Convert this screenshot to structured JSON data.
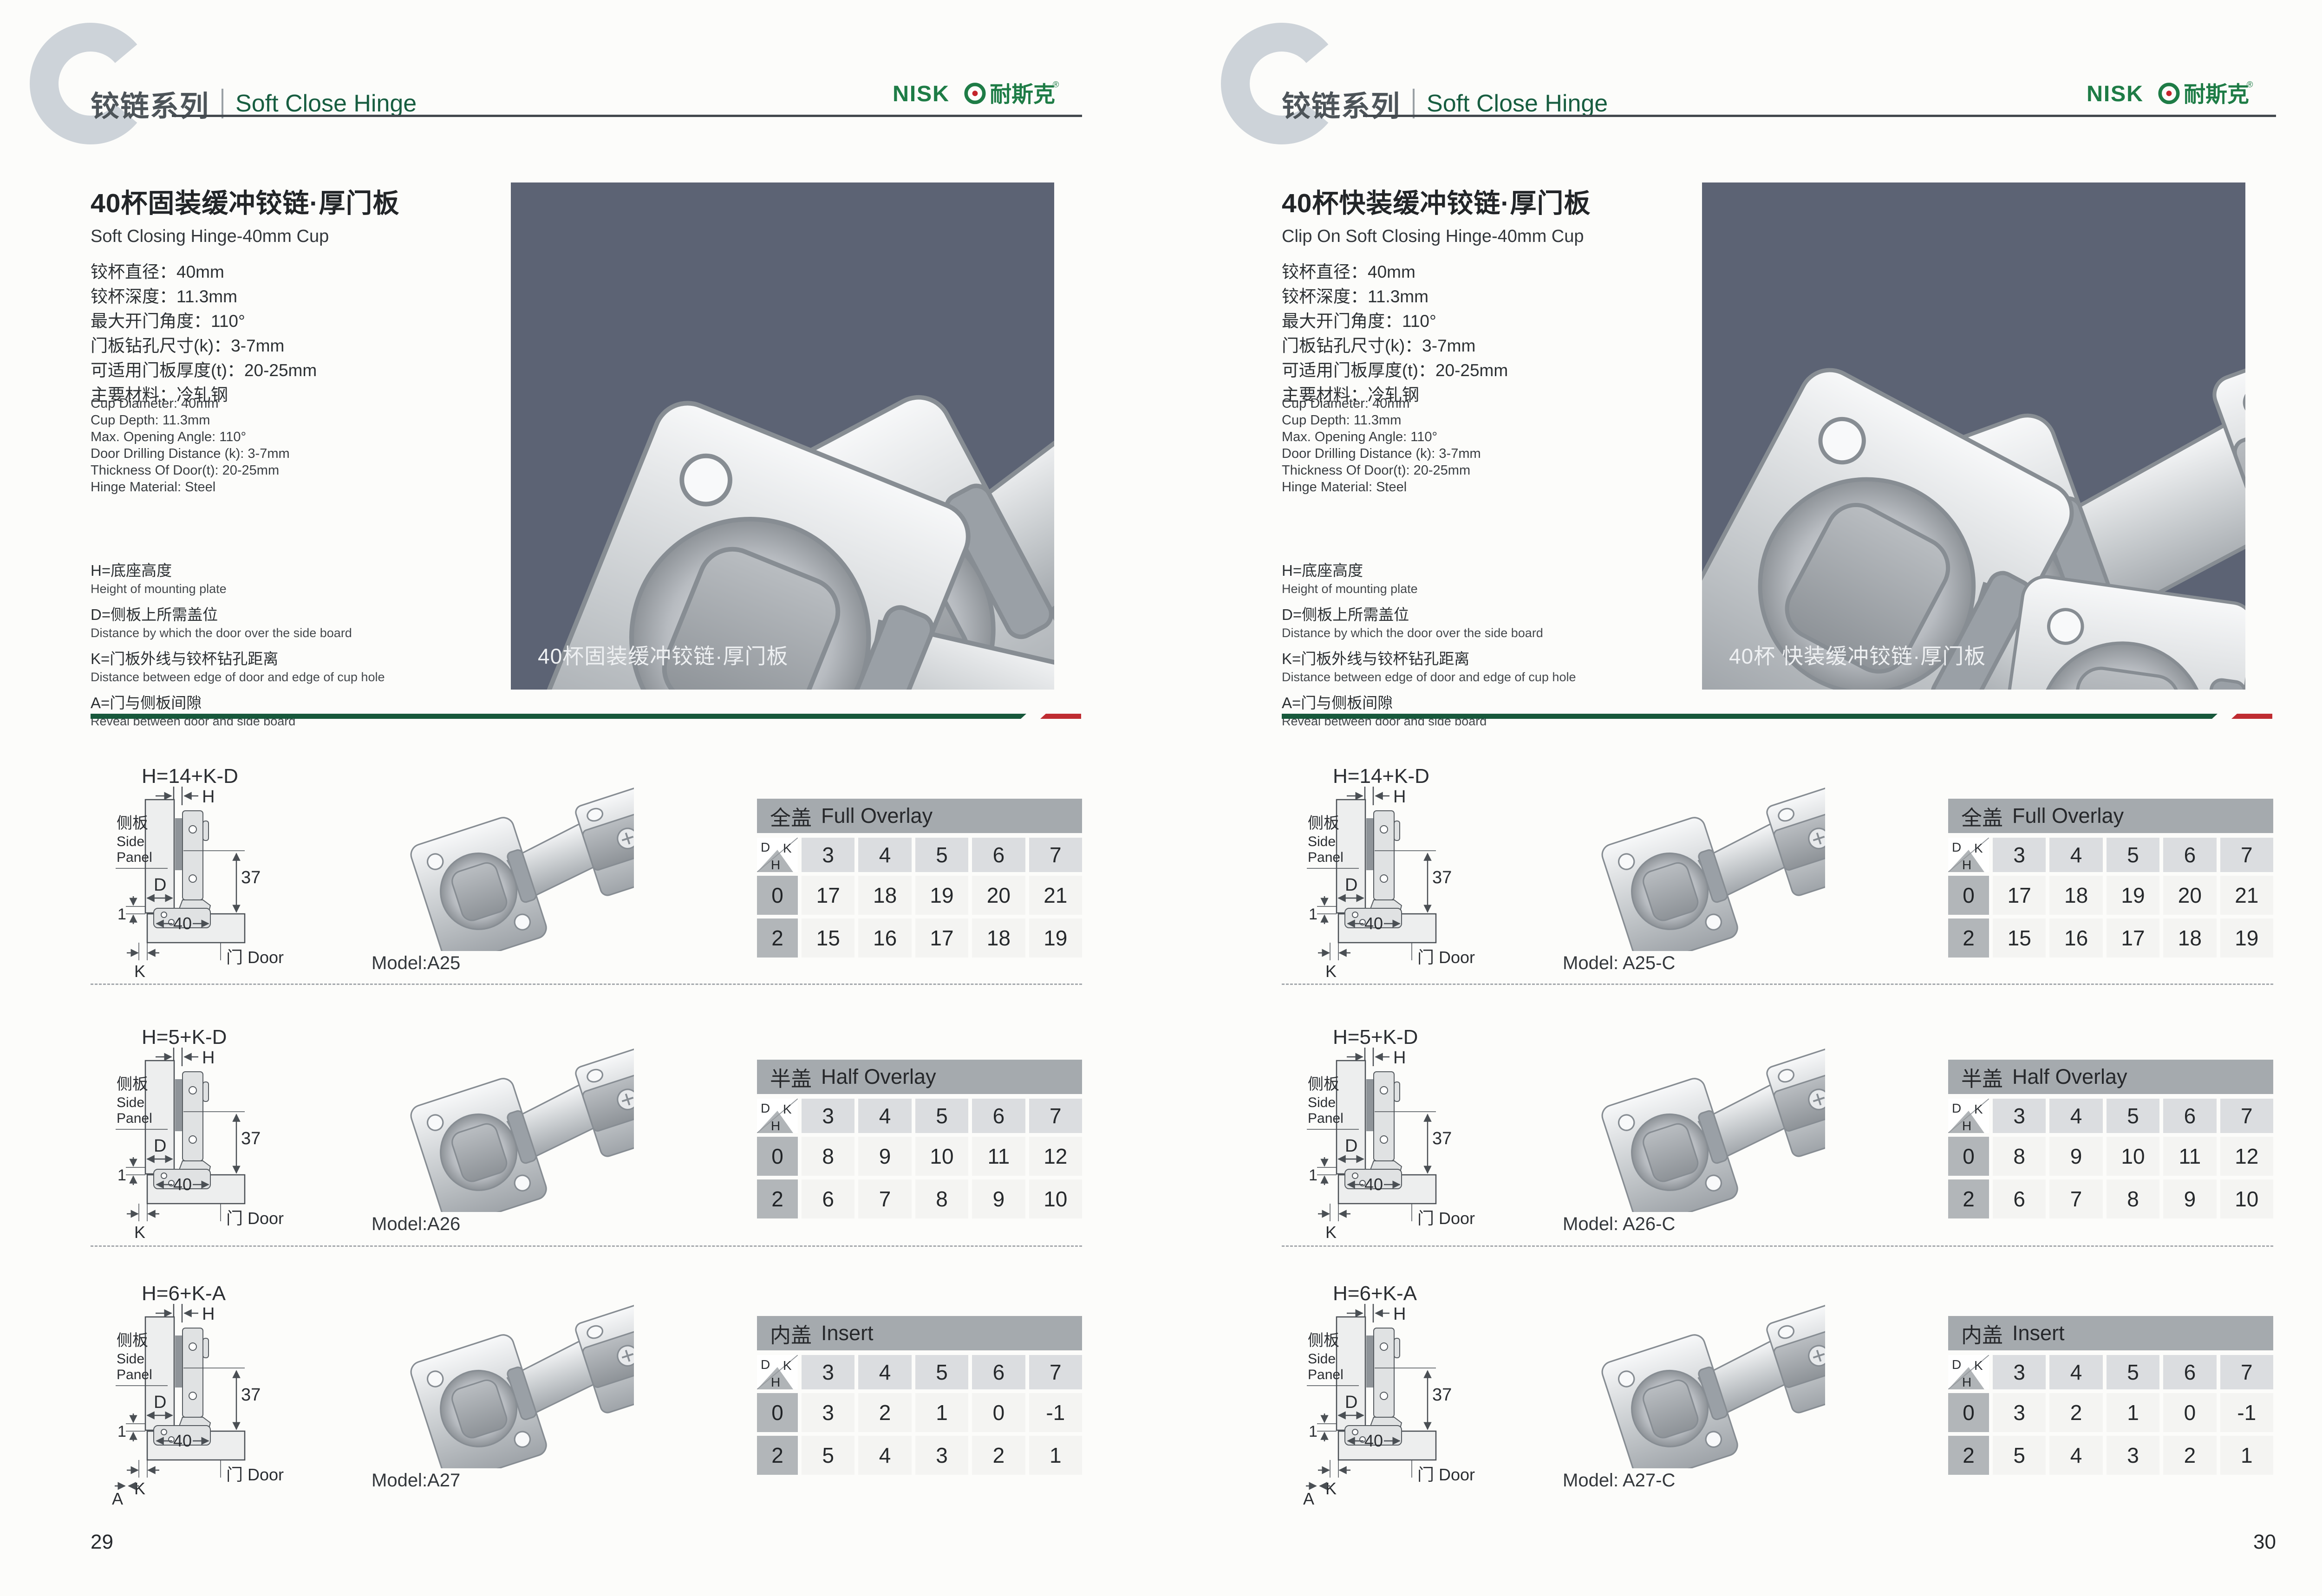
{
  "shared": {
    "corner": {
      "d": "D",
      "k": "K",
      "h": "H"
    },
    "diagram": {
      "h": "H",
      "side_cn": "侧板",
      "side_en1": "Side",
      "side_en2": "Panel",
      "d": "D",
      "one": "1",
      "forty": "40",
      "thirtyseven": "37",
      "k": "K",
      "door": "门 Door",
      "a": "A"
    },
    "logo": {
      "latin": "NISK",
      "cn": "耐斯克",
      "reg": "®"
    },
    "colors": {
      "brand_green": "#1e7c46",
      "divider_green": "#17583b",
      "divider_red": "#bf2c31",
      "photo_panel": "#5c6374",
      "logo_dot_red": "#c4232b"
    }
  },
  "pages": [
    {
      "header": {
        "series_cn": "铰链系列",
        "series_en": "Soft Close Hinge"
      },
      "product": {
        "title_cn": "40杯固装缓冲铰链·厚门板",
        "title_en": "Soft Closing Hinge-40mm Cup",
        "specs_cn": [
          "铰杯直径：40mm",
          "铰杯深度：11.3mm",
          "最大开门角度：110°",
          "门板钻孔尺寸(k)：3-7mm",
          "可适用门板厚度(t)：20-25mm",
          "主要材料：冷轧钢"
        ],
        "specs_en": [
          "Cup Diameter: 40mm",
          "Cup Depth: 11.3mm",
          "Max. Opening Angle: 110°",
          "Door Drilling Distance (k): 3-7mm",
          "Thickness Of Door(t): 20-25mm",
          "Hinge Material: Steel"
        ],
        "definitions": [
          {
            "cn": "H=底座高度",
            "en": "Height of mounting plate"
          },
          {
            "cn": "D=侧板上所需盖位",
            "en": "Distance by which the door over the side board"
          },
          {
            "cn": "K=门板外线与铰杯钻孔距离",
            "en": "Distance between edge of door and edge of cup hole"
          },
          {
            "cn": "A=门与侧板间隙",
            "en": "Reveal between door and side board"
          }
        ],
        "photo_caption": "40杯固装缓冲铰链·厚门板"
      },
      "rows": [
        {
          "formula": "H=14+K-D",
          "model": "Model:A25",
          "show_a": false,
          "table": {
            "title_cn": "全盖",
            "title_en": "Full Overlay",
            "columns": [
              "3",
              "4",
              "5",
              "6",
              "7"
            ],
            "rows": [
              {
                "label": "0",
                "values": [
                  "17",
                  "18",
                  "19",
                  "20",
                  "21"
                ]
              },
              {
                "label": "2",
                "values": [
                  "15",
                  "16",
                  "17",
                  "18",
                  "19"
                ]
              }
            ]
          }
        },
        {
          "formula": "H=5+K-D",
          "model": "Model:A26",
          "show_a": false,
          "table": {
            "title_cn": "半盖",
            "title_en": "Half Overlay",
            "columns": [
              "3",
              "4",
              "5",
              "6",
              "7"
            ],
            "rows": [
              {
                "label": "0",
                "values": [
                  "8",
                  "9",
                  "10",
                  "11",
                  "12"
                ]
              },
              {
                "label": "2",
                "values": [
                  "6",
                  "7",
                  "8",
                  "9",
                  "10"
                ]
              }
            ]
          }
        },
        {
          "formula": "H=6+K-A",
          "model": "Model:A27",
          "show_a": true,
          "table": {
            "title_cn": "内盖",
            "title_en": "Insert",
            "columns": [
              "3",
              "4",
              "5",
              "6",
              "7"
            ],
            "rows": [
              {
                "label": "0",
                "values": [
                  "3",
                  "2",
                  "1",
                  "0",
                  "-1"
                ]
              },
              {
                "label": "2",
                "values": [
                  "5",
                  "4",
                  "3",
                  "2",
                  "1"
                ]
              }
            ]
          }
        }
      ],
      "page_number": "29"
    },
    {
      "header": {
        "series_cn": "铰链系列",
        "series_en": "Soft Close Hinge"
      },
      "product": {
        "title_cn": "40杯快装缓冲铰链·厚门板",
        "title_en": "Clip On Soft Closing Hinge-40mm Cup",
        "specs_cn": [
          "铰杯直径：40mm",
          "铰杯深度：11.3mm",
          "最大开门角度：110°",
          "门板钻孔尺寸(k)：3-7mm",
          "可适用门板厚度(t)：20-25mm",
          "主要材料：冷轧钢"
        ],
        "specs_en": [
          "Cup Diameter: 40mm",
          "Cup Depth: 11.3mm",
          "Max. Opening Angle: 110°",
          "Door Drilling Distance (k): 3-7mm",
          "Thickness Of Door(t): 20-25mm",
          "Hinge Material: Steel"
        ],
        "definitions": [
          {
            "cn": "H=底座高度",
            "en": "Height of mounting plate"
          },
          {
            "cn": "D=侧板上所需盖位",
            "en": "Distance by which the door over the side board"
          },
          {
            "cn": "K=门板外线与铰杯钻孔距离",
            "en": "Distance between edge of door and edge of cup hole"
          },
          {
            "cn": "A=门与侧板间隙",
            "en": "Reveal between door and side board"
          }
        ],
        "photo_caption": "40杯 快装缓冲铰链·厚门板"
      },
      "rows": [
        {
          "formula": "H=14+K-D",
          "model": "Model: A25-C",
          "show_a": false,
          "table": {
            "title_cn": "全盖",
            "title_en": "Full Overlay",
            "columns": [
              "3",
              "4",
              "5",
              "6",
              "7"
            ],
            "rows": [
              {
                "label": "0",
                "values": [
                  "17",
                  "18",
                  "19",
                  "20",
                  "21"
                ]
              },
              {
                "label": "2",
                "values": [
                  "15",
                  "16",
                  "17",
                  "18",
                  "19"
                ]
              }
            ]
          }
        },
        {
          "formula": "H=5+K-D",
          "model": "Model: A26-C",
          "show_a": false,
          "table": {
            "title_cn": "半盖",
            "title_en": "Half Overlay",
            "columns": [
              "3",
              "4",
              "5",
              "6",
              "7"
            ],
            "rows": [
              {
                "label": "0",
                "values": [
                  "8",
                  "9",
                  "10",
                  "11",
                  "12"
                ]
              },
              {
                "label": "2",
                "values": [
                  "6",
                  "7",
                  "8",
                  "9",
                  "10"
                ]
              }
            ]
          }
        },
        {
          "formula": "H=6+K-A",
          "model": "Model: A27-C",
          "show_a": true,
          "table": {
            "title_cn": "内盖",
            "title_en": "Insert",
            "columns": [
              "3",
              "4",
              "5",
              "6",
              "7"
            ],
            "rows": [
              {
                "label": "0",
                "values": [
                  "3",
                  "2",
                  "1",
                  "0",
                  "-1"
                ]
              },
              {
                "label": "2",
                "values": [
                  "5",
                  "4",
                  "3",
                  "2",
                  "1"
                ]
              }
            ]
          }
        }
      ],
      "page_number": "30"
    }
  ]
}
